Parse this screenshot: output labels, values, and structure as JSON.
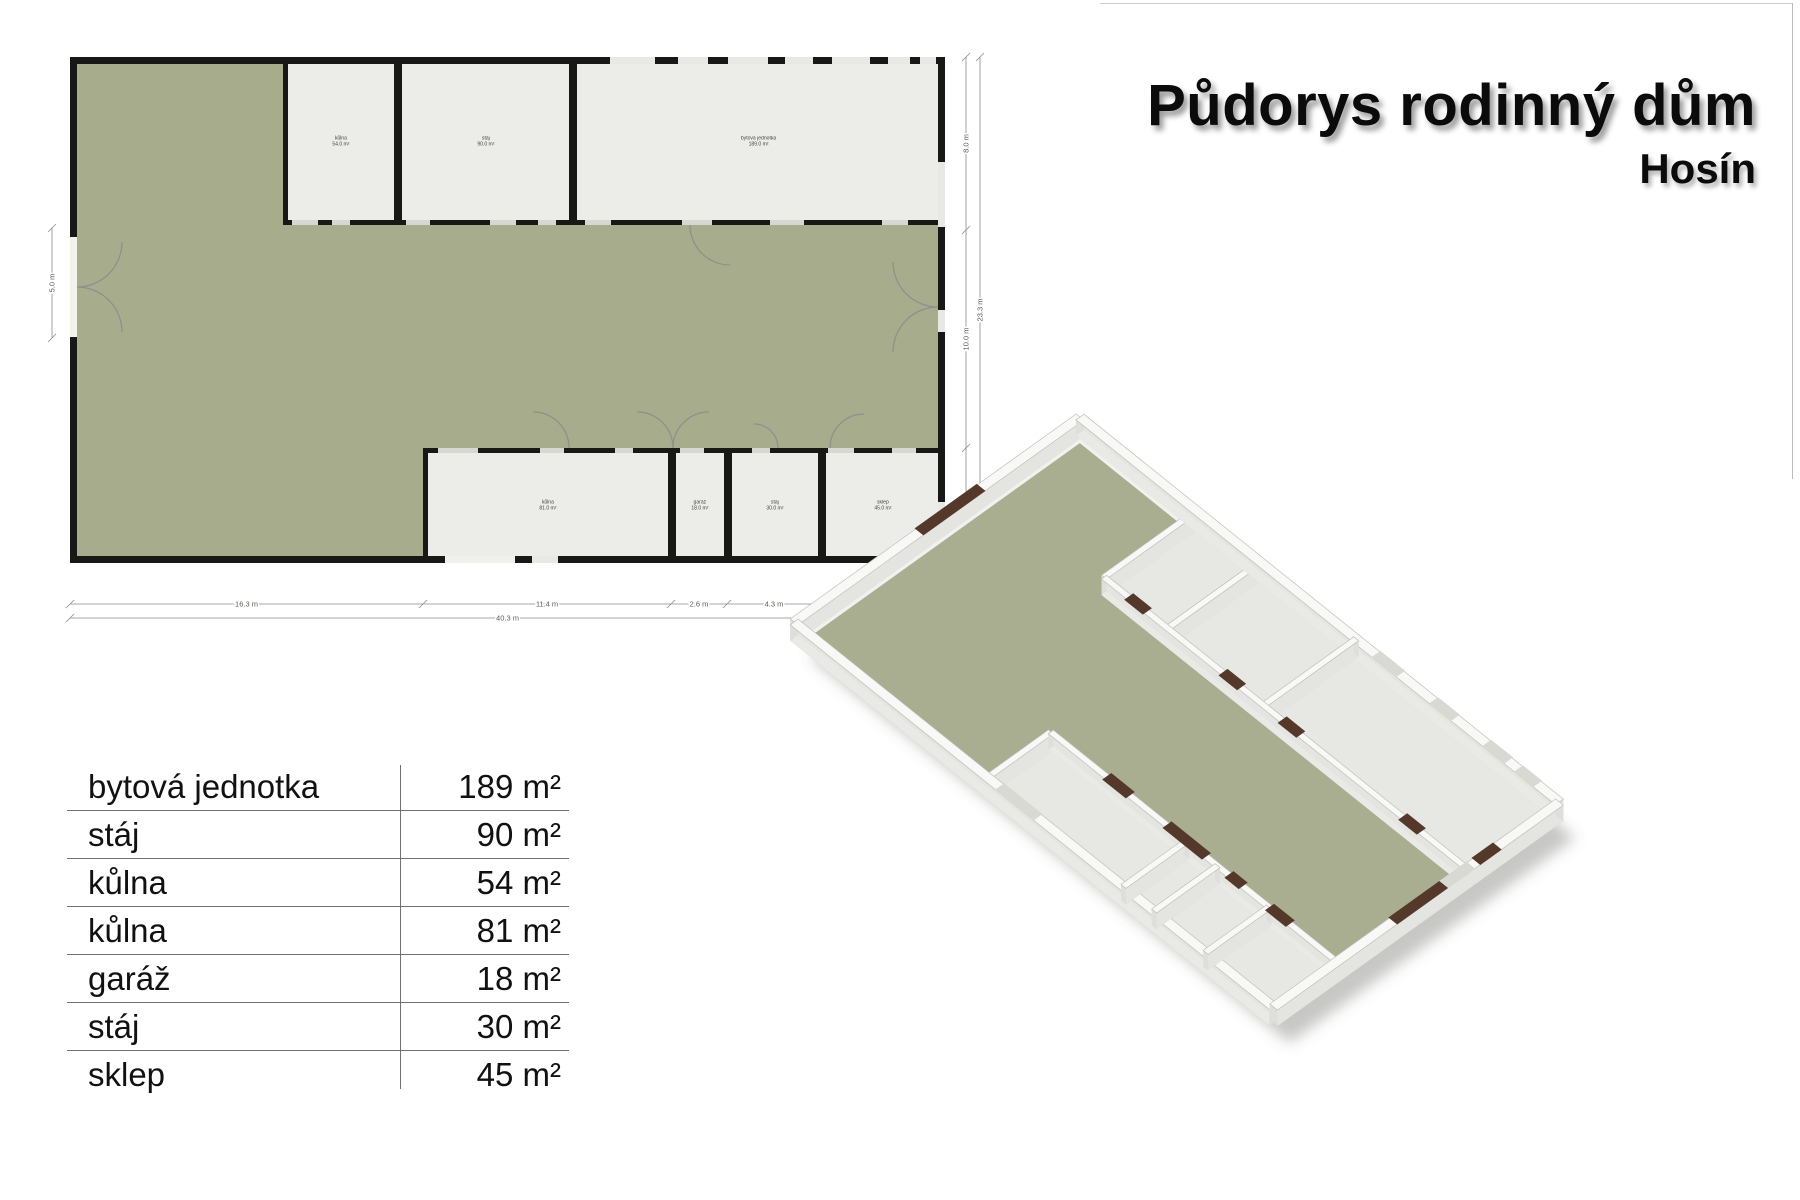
{
  "title": "Půdorys rodinný dům",
  "subtitle": "Hosín",
  "legend": {
    "rows": [
      {
        "name": "bytová jednotka",
        "area": "189 m²"
      },
      {
        "name": "stáj",
        "area": "90 m²"
      },
      {
        "name": "kůlna",
        "area": "54 m²"
      },
      {
        "name": "kůlna",
        "area": "81 m²"
      },
      {
        "name": "garáž",
        "area": "18 m²"
      },
      {
        "name": "stáj",
        "area": "30 m²"
      },
      {
        "name": "sklep",
        "area": "45 m²"
      }
    ]
  },
  "plan": {
    "colors": {
      "wall": "#181816",
      "courtyard": "#a7ac8c",
      "room": "#ecede8",
      "courtyard3d": "#a9ae90",
      "room3d": "#e7e8e3",
      "wall3d_top": "#f8f8f6",
      "door3d": "#54392b",
      "dim_line": "#8a8a8a",
      "dim_text": "#5a5a55"
    },
    "rooms": [
      {
        "id": "kulna-54",
        "label": "kůlna",
        "area": "54.0 m²",
        "x": 213,
        "y": 0,
        "w": 116,
        "h": 168
      },
      {
        "id": "staj-90",
        "label": "stáj",
        "area": "90.0 m²",
        "x": 327,
        "y": 0,
        "w": 177,
        "h": 168
      },
      {
        "id": "byt-189",
        "label": "bytová jednotka",
        "area": "189.0 m²",
        "x": 502,
        "y": 0,
        "w": 373,
        "h": 168
      },
      {
        "id": "kulna-81",
        "label": "kůlna",
        "area": "81.0 m²",
        "x": 353,
        "y": 391,
        "w": 250,
        "h": 115
      },
      {
        "id": "garaz-18",
        "label": "garáž",
        "area": "18.0 m²",
        "x": 601,
        "y": 391,
        "w": 58,
        "h": 115
      },
      {
        "id": "staj-30",
        "label": "stáj",
        "area": "30.0 m²",
        "x": 657,
        "y": 391,
        "w": 96,
        "h": 115
      },
      {
        "id": "sklep-45",
        "label": "sklep",
        "area": "45.0 m²",
        "x": 751,
        "y": 391,
        "w": 124,
        "h": 115
      }
    ],
    "windows2d": [
      [
        540,
        0,
        45,
        7,
        "#e8e8e4"
      ],
      [
        608,
        0,
        30,
        7,
        "#e8e8e4"
      ],
      [
        658,
        0,
        40,
        7,
        "#e8e8e4"
      ],
      [
        715,
        0,
        28,
        7,
        "#e8e8e4"
      ],
      [
        762,
        0,
        38,
        7,
        "#e8e8e4"
      ],
      [
        818,
        0,
        22,
        7,
        "#e8e8e4"
      ],
      [
        850,
        0,
        16,
        7,
        "#e8e8e4"
      ],
      [
        0,
        180,
        7,
        100,
        "#f2f2ef"
      ],
      [
        868,
        105,
        7,
        65,
        "#e8e8e4"
      ],
      [
        868,
        253,
        7,
        22,
        "#e8e8e4"
      ],
      [
        868,
        445,
        7,
        40,
        "#e8e8e4"
      ],
      [
        375,
        499,
        70,
        7,
        "#f0f0ec"
      ],
      [
        462,
        499,
        26,
        7,
        "#e8e8e4"
      ],
      [
        222,
        163,
        26,
        5,
        "#d8d8d3"
      ],
      [
        262,
        163,
        18,
        5,
        "#d8d8d3"
      ],
      [
        336,
        163,
        24,
        5,
        "#d8d8d3"
      ],
      [
        420,
        163,
        26,
        5,
        "#d8d8d3"
      ],
      [
        468,
        163,
        18,
        5,
        "#d8d8d3"
      ],
      [
        515,
        163,
        26,
        5,
        "#d8d8d3"
      ],
      [
        612,
        163,
        30,
        5,
        "#d8d8d3"
      ],
      [
        700,
        163,
        34,
        5,
        "#d8d8d3"
      ],
      [
        812,
        163,
        26,
        5,
        "#d8d8d3"
      ],
      [
        368,
        391,
        40,
        5,
        "#d8d8d3"
      ],
      [
        470,
        391,
        24,
        5,
        "#d8d8d3"
      ],
      [
        545,
        391,
        18,
        5,
        "#d8d8d3"
      ],
      [
        610,
        391,
        24,
        5,
        "#d8d8d3"
      ],
      [
        682,
        391,
        18,
        5,
        "#d8d8d3"
      ],
      [
        758,
        391,
        26,
        5,
        "#d8d8d3"
      ],
      [
        822,
        391,
        24,
        5,
        "#d8d8d3"
      ]
    ],
    "door_arcs": [
      "M282,128 A40,40 0 0 1 322,168",
      "M455,128 A40,40 0 0 1 495,168",
      "M560,128 A40,40 0 0 1 600,168",
      "M790,128 A40,40 0 0 0 750,168",
      "M660,208 A40,40 0 0 1 620,168",
      "M463,355 A36,36 0 0 1 499,391",
      "M567,355 A36,36 0 0 1 603,391",
      "M639,355 A36,36 0 0 0 603,391",
      "M684,367 A24,24 0 0 1 708,391",
      "M794,357 A34,34 0 0 0 760,391",
      "M52,185 A45,45 0 0 1 7,230",
      "M7,230 A45,45 0 0 1 52,275",
      "M868,148 A38,38 0 0 1 830,110",
      "M823,205 A45,45 0 0 0 868,250",
      "M868,250 A45,45 0 0 0 823,295"
    ],
    "walls3d": [
      [
        213,
        0,
        213,
        164
      ],
      [
        329,
        0,
        329,
        164
      ],
      [
        504,
        0,
        504,
        164
      ],
      [
        213,
        164,
        875,
        164
      ],
      [
        353,
        394,
        875,
        394
      ],
      [
        353,
        394,
        353,
        506
      ],
      [
        601,
        394,
        601,
        506
      ],
      [
        657,
        394,
        657,
        506
      ],
      [
        751,
        394,
        751,
        506
      ]
    ],
    "doors3d": [
      {
        "o": "v",
        "x": 0,
        "v0": 175,
        "v1": 285
      },
      {
        "o": "v",
        "x": 875,
        "v0": 205,
        "v1": 295
      },
      {
        "o": "v",
        "x": 875,
        "v0": 110,
        "v1": 148
      },
      {
        "o": "h",
        "y": 164,
        "u0": 258,
        "u1": 292
      },
      {
        "o": "h",
        "y": 164,
        "u0": 430,
        "u1": 464
      },
      {
        "o": "h",
        "y": 164,
        "u0": 538,
        "u1": 572
      },
      {
        "o": "h",
        "y": 164,
        "u0": 758,
        "u1": 792
      },
      {
        "o": "h",
        "y": 394,
        "u0": 455,
        "u1": 498
      },
      {
        "o": "h",
        "y": 394,
        "u0": 565,
        "u1": 637
      },
      {
        "o": "h",
        "y": 394,
        "u0": 678,
        "u1": 704
      },
      {
        "o": "h",
        "y": 394,
        "u0": 752,
        "u1": 790
      }
    ],
    "windows3d": [
      {
        "o": "h",
        "y": 0,
        "u0": 540,
        "u1": 585
      },
      {
        "o": "h",
        "y": 0,
        "u0": 645,
        "u1": 685
      },
      {
        "o": "h",
        "y": 0,
        "u0": 742,
        "u1": 782
      },
      {
        "o": "h",
        "y": 0,
        "u0": 800,
        "u1": 835
      },
      {
        "o": "v",
        "x": 875,
        "v0": 157,
        "v1": 222
      },
      {
        "o": "h",
        "y": 506,
        "u0": 375,
        "u1": 445
      }
    ],
    "dims": {
      "bottom": {
        "y": 604,
        "ticks": [
          70,
          423,
          671,
          727,
          821,
          945
        ],
        "labels": [
          "16.3 m",
          "11.4 m",
          "2.6 m",
          "4.3 m",
          "5.7 m"
        ],
        "total_y": 618,
        "total_label": "40.3 m"
      },
      "right": {
        "x": 966,
        "ticks": [
          57,
          230,
          448,
          563
        ],
        "labels": [
          "8.0 m",
          "10.0 m",
          "5.3 m"
        ],
        "total_x": 980,
        "total_label": "23.3 m"
      },
      "left": {
        "x": 52,
        "ticks": [
          228,
          338
        ],
        "labels": [
          "5.0 m"
        ]
      }
    }
  }
}
